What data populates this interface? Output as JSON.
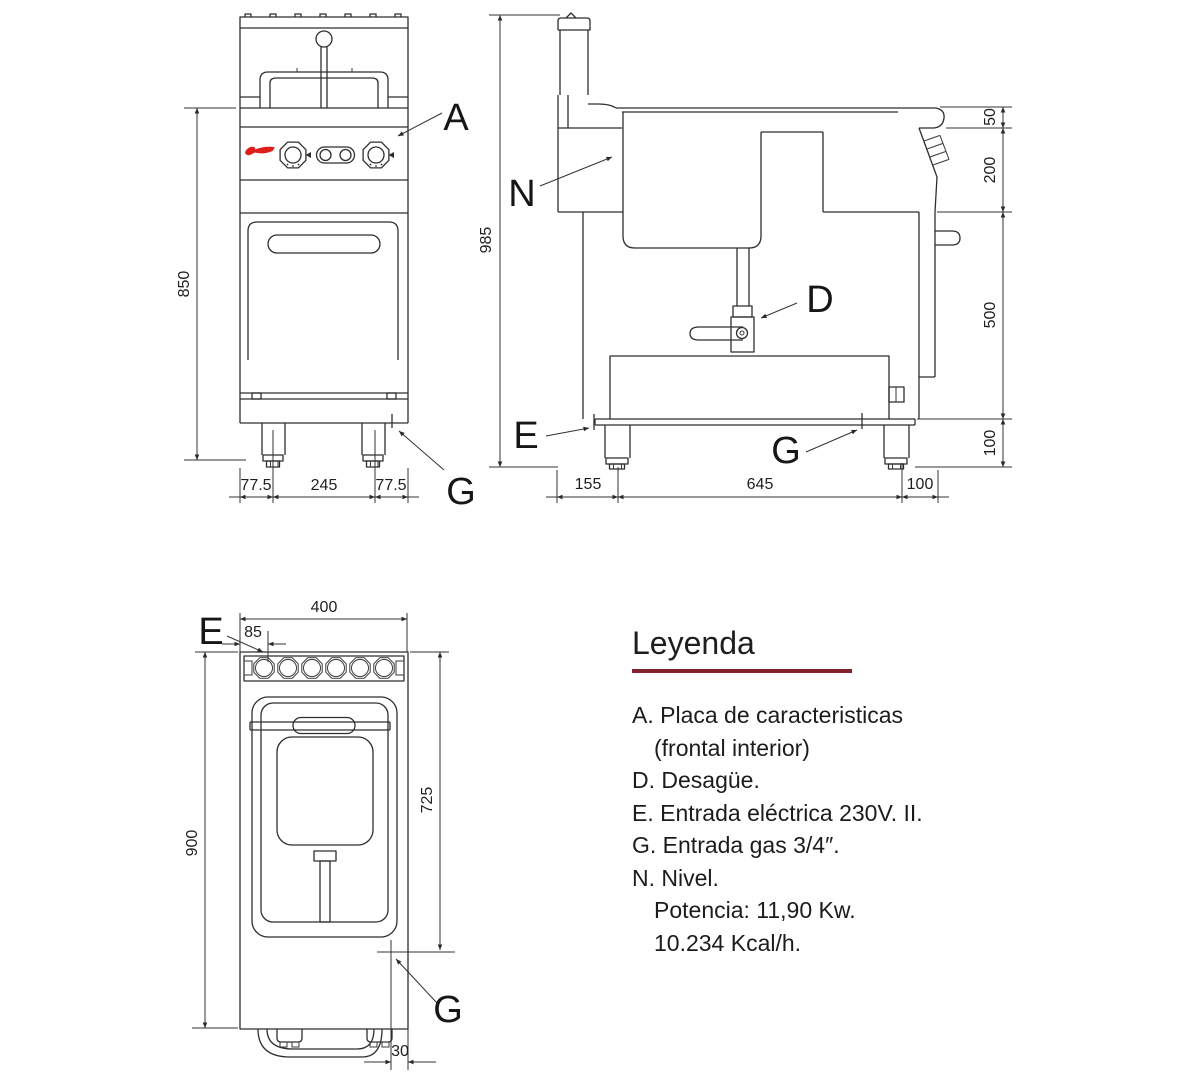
{
  "drawing": {
    "front_view": {
      "dim_height": "850",
      "dim_foot_left": "77.5",
      "dim_legs_span": "245",
      "dim_foot_right": "77.5",
      "callout_a": "A",
      "callout_g": "G"
    },
    "side_view": {
      "dim_height": "985",
      "dim_splash": "50",
      "dim_panel": "200",
      "dim_body": "500",
      "dim_legs": "100",
      "dim_back": "155",
      "dim_depth": "645",
      "dim_front": "100",
      "callout_n": "N",
      "callout_d": "D",
      "callout_e": "E",
      "callout_g": "G"
    },
    "plan_view": {
      "dim_width": "400",
      "dim_elec": "85",
      "dim_depth": "900",
      "dim_inner": "725",
      "dim_gas": "30",
      "callout_e": "E",
      "callout_g": "G"
    }
  },
  "legend": {
    "title": "Leyenda",
    "items": [
      "A. Placa de caracteristicas",
      "(frontal interior)",
      "D. Desagüe.",
      "E. Entrada eléctrica 230V. II.",
      "G. Entrada gas 3/4″.",
      "N. Nivel.",
      "Potencia: 11,90 Kw.",
      "10.234 Kcal/h."
    ]
  },
  "colors": {
    "logo_red": "#df1f1c",
    "legend_rule": "#82222e",
    "line": "#2e2e2e"
  }
}
